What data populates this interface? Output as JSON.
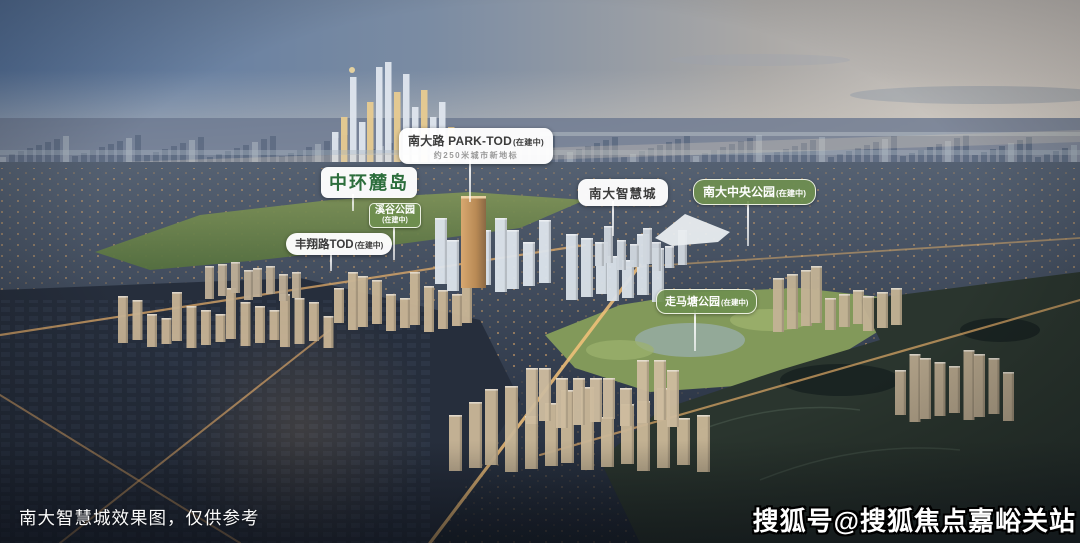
{
  "scene": {
    "caption": "南大智慧城效果图，仅供参考",
    "watermark": "搜狐号@搜狐焦点嘉峪关站"
  },
  "labels": {
    "park_tod": {
      "title": "南大路 PARK-TOD",
      "status": "(在建中)",
      "subtitle": "约250米城市新地标"
    },
    "zhonghuan_ludao": {
      "title": "中环麓岛"
    },
    "xigu_park": {
      "title": "溪谷公园",
      "status": "(在建中)"
    },
    "fengxiang_tod": {
      "title": "丰翔路TOD",
      "status": "(在建中)"
    },
    "nanda_smart_city": {
      "title": "南大智慧城"
    },
    "nanda_central_park": {
      "title": "南大中央公园",
      "status": "(在建中)"
    },
    "zoumatang_park": {
      "title": "走马塘公园",
      "status": "(在建中)"
    }
  },
  "colors": {
    "badge_white_bg": "#ffffff",
    "badge_dark_text": "#3b3b3b",
    "badge_green_bg": "#6f8f4f",
    "ludao_green_text": "#2c6e3c",
    "connector_white": "#ffffff"
  }
}
